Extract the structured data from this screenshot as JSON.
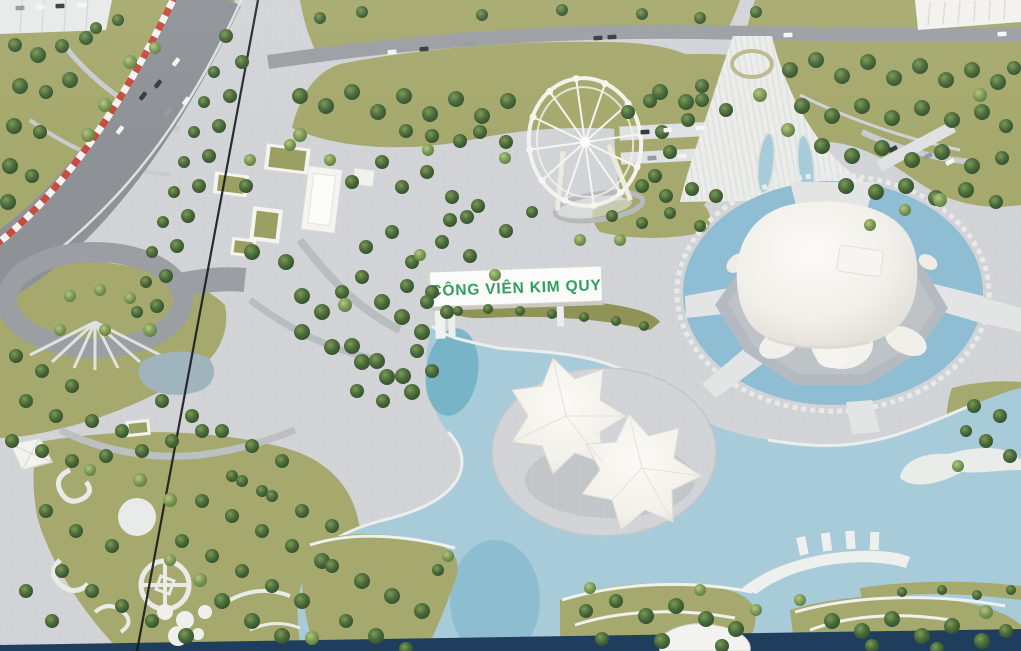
{
  "scene": {
    "kind": "photograph-of-architectural-scale-model",
    "subject": "aerial view of a park master-plan miniature with turtle-shaped building, leaf canopy building, ferris wheel, lake, roads and trees",
    "sign": {
      "text": "CÔNG VIÊN KIM QUY"
    }
  },
  "colors": {
    "plaza": "#d2d4d7",
    "plazaLine": "#bfc3c7",
    "lawn": "#a6a96d",
    "lawnDark": "#8f9355",
    "lawnLight": "#b5b77f",
    "road": "#9b9fa4",
    "roadDark": "#8e9297",
    "pathLight": "#c9ccd0",
    "white": "#f3f2ee",
    "whiteShadow": "#d7d6d0",
    "water": "#a7cbd9",
    "waterMoat": "#8fbdd3",
    "waterDeep": "#6fb0c4",
    "navy": "#1f3d5c",
    "barrierRed": "#c74b3f",
    "signGreen": "#2f9e5f",
    "seam": "#17181b"
  },
  "car_colors": {
    "w": "#f5f5f3",
    "d": "#363b42",
    "g": "#959ba3"
  },
  "trees": {
    "dark": [
      [
        15,
        45,
        7
      ],
      [
        38,
        55,
        8
      ],
      [
        62,
        46,
        7
      ],
      [
        86,
        38,
        7
      ],
      [
        20,
        86,
        8
      ],
      [
        46,
        92,
        7
      ],
      [
        70,
        80,
        8
      ],
      [
        14,
        126,
        8
      ],
      [
        40,
        132,
        7
      ],
      [
        10,
        166,
        8
      ],
      [
        32,
        176,
        7
      ],
      [
        8,
        202,
        8
      ],
      [
        96,
        28,
        6
      ],
      [
        118,
        20,
        6
      ],
      [
        226,
        36,
        7
      ],
      [
        242,
        62,
        7
      ],
      [
        214,
        72,
        6
      ],
      [
        230,
        96,
        7
      ],
      [
        204,
        102,
        6
      ],
      [
        219,
        126,
        7
      ],
      [
        194,
        132,
        6
      ],
      [
        209,
        156,
        7
      ],
      [
        184,
        162,
        6
      ],
      [
        199,
        186,
        7
      ],
      [
        174,
        192,
        6
      ],
      [
        188,
        216,
        7
      ],
      [
        163,
        222,
        6
      ],
      [
        177,
        246,
        7
      ],
      [
        152,
        252,
        6
      ],
      [
        166,
        276,
        7
      ],
      [
        146,
        282,
        6
      ],
      [
        157,
        306,
        7
      ],
      [
        137,
        312,
        6
      ],
      [
        246,
        186,
        7
      ],
      [
        252,
        252,
        8
      ],
      [
        286,
        262,
        8
      ],
      [
        302,
        296,
        8
      ],
      [
        322,
        312,
        8
      ],
      [
        342,
        292,
        7
      ],
      [
        362,
        277,
        7
      ],
      [
        382,
        302,
        8
      ],
      [
        402,
        317,
        8
      ],
      [
        422,
        332,
        8
      ],
      [
        366,
        247,
        7
      ],
      [
        392,
        232,
        7
      ],
      [
        412,
        262,
        7
      ],
      [
        432,
        292,
        7
      ],
      [
        447,
        312,
        7
      ],
      [
        352,
        182,
        7
      ],
      [
        382,
        162,
        7
      ],
      [
        402,
        187,
        7
      ],
      [
        427,
        172,
        7
      ],
      [
        452,
        197,
        7
      ],
      [
        467,
        217,
        7
      ],
      [
        442,
        242,
        7
      ],
      [
        302,
        332,
        8
      ],
      [
        332,
        347,
        8
      ],
      [
        362,
        362,
        8
      ],
      [
        387,
        377,
        8
      ],
      [
        412,
        392,
        8
      ],
      [
        352,
        346,
        8
      ],
      [
        377,
        361,
        8
      ],
      [
        403,
        376,
        8
      ],
      [
        417,
        351,
        7
      ],
      [
        427,
        302,
        7
      ],
      [
        407,
        286,
        7
      ],
      [
        432,
        371,
        7
      ],
      [
        357,
        391,
        7
      ],
      [
        383,
        401,
        7
      ],
      [
        300,
        96,
        8
      ],
      [
        326,
        106,
        8
      ],
      [
        352,
        92,
        8
      ],
      [
        378,
        112,
        8
      ],
      [
        404,
        96,
        8
      ],
      [
        430,
        114,
        8
      ],
      [
        456,
        99,
        8
      ],
      [
        482,
        116,
        8
      ],
      [
        508,
        101,
        8
      ],
      [
        480,
        132,
        7
      ],
      [
        506,
        142,
        7
      ],
      [
        460,
        141,
        7
      ],
      [
        432,
        136,
        7
      ],
      [
        406,
        131,
        7
      ],
      [
        660,
        92,
        8
      ],
      [
        686,
        102,
        8
      ],
      [
        702,
        86,
        7
      ],
      [
        662,
        132,
        7
      ],
      [
        688,
        120,
        7
      ],
      [
        670,
        152,
        7
      ],
      [
        655,
        176,
        7
      ],
      [
        320,
        18,
        6
      ],
      [
        362,
        12,
        6
      ],
      [
        482,
        15,
        6
      ],
      [
        562,
        10,
        6
      ],
      [
        642,
        14,
        6
      ],
      [
        700,
        18,
        6
      ],
      [
        756,
        12,
        6
      ],
      [
        790,
        70,
        8
      ],
      [
        816,
        60,
        8
      ],
      [
        842,
        76,
        8
      ],
      [
        868,
        62,
        8
      ],
      [
        894,
        78,
        8
      ],
      [
        920,
        66,
        8
      ],
      [
        946,
        80,
        8
      ],
      [
        972,
        70,
        8
      ],
      [
        998,
        82,
        8
      ],
      [
        1014,
        68,
        7
      ],
      [
        802,
        106,
        8
      ],
      [
        832,
        116,
        8
      ],
      [
        862,
        106,
        8
      ],
      [
        892,
        118,
        8
      ],
      [
        922,
        108,
        8
      ],
      [
        952,
        120,
        8
      ],
      [
        982,
        112,
        8
      ],
      [
        1006,
        126,
        7
      ],
      [
        822,
        146,
        8
      ],
      [
        852,
        156,
        8
      ],
      [
        882,
        148,
        8
      ],
      [
        912,
        160,
        8
      ],
      [
        942,
        152,
        8
      ],
      [
        972,
        166,
        8
      ],
      [
        1002,
        158,
        7
      ],
      [
        846,
        186,
        8
      ],
      [
        876,
        192,
        8
      ],
      [
        906,
        186,
        8
      ],
      [
        936,
        198,
        8
      ],
      [
        966,
        190,
        8
      ],
      [
        996,
        202,
        7
      ],
      [
        628,
        112,
        7
      ],
      [
        650,
        101,
        7
      ],
      [
        702,
        100,
        7
      ],
      [
        726,
        110,
        7
      ],
      [
        642,
        186,
        7
      ],
      [
        666,
        196,
        7
      ],
      [
        692,
        189,
        7
      ],
      [
        716,
        196,
        7
      ],
      [
        612,
        216,
        6
      ],
      [
        642,
        223,
        6
      ],
      [
        670,
        213,
        6
      ],
      [
        700,
        226,
        6
      ],
      [
        450,
        220,
        7
      ],
      [
        478,
        206,
        7
      ],
      [
        506,
        231,
        7
      ],
      [
        470,
        256,
        7
      ],
      [
        532,
        212,
        6
      ],
      [
        458,
        311,
        5
      ],
      [
        488,
        309,
        5
      ],
      [
        520,
        311,
        5
      ],
      [
        552,
        314,
        5
      ],
      [
        584,
        317,
        5
      ],
      [
        616,
        321,
        5
      ],
      [
        644,
        326,
        5
      ],
      [
        974,
        406,
        7
      ],
      [
        1000,
        416,
        7
      ],
      [
        986,
        441,
        7
      ],
      [
        1010,
        456,
        7
      ],
      [
        966,
        431,
        6
      ],
      [
        16,
        356,
        7
      ],
      [
        42,
        371,
        7
      ],
      [
        72,
        386,
        7
      ],
      [
        26,
        401,
        7
      ],
      [
        56,
        416,
        7
      ],
      [
        92,
        421,
        7
      ],
      [
        122,
        431,
        7
      ],
      [
        12,
        441,
        7
      ],
      [
        42,
        451,
        7
      ],
      [
        72,
        461,
        7
      ],
      [
        106,
        456,
        7
      ],
      [
        142,
        451,
        7
      ],
      [
        172,
        441,
        7
      ],
      [
        202,
        431,
        7
      ],
      [
        162,
        401,
        7
      ],
      [
        192,
        416,
        7
      ],
      [
        222,
        431,
        7
      ],
      [
        252,
        446,
        7
      ],
      [
        282,
        461,
        7
      ],
      [
        232,
        476,
        6
      ],
      [
        262,
        491,
        6
      ],
      [
        46,
        511,
        7
      ],
      [
        76,
        531,
        7
      ],
      [
        112,
        546,
        7
      ],
      [
        62,
        571,
        7
      ],
      [
        92,
        591,
        7
      ],
      [
        122,
        606,
        7
      ],
      [
        152,
        621,
        7
      ],
      [
        186,
        636,
        8
      ],
      [
        52,
        621,
        7
      ],
      [
        26,
        591,
        7
      ],
      [
        222,
        601,
        8
      ],
      [
        252,
        621,
        8
      ],
      [
        282,
        636,
        8
      ],
      [
        182,
        541,
        7
      ],
      [
        212,
        556,
        7
      ],
      [
        242,
        571,
        7
      ],
      [
        272,
        586,
        7
      ],
      [
        302,
        601,
        8
      ],
      [
        202,
        501,
        7
      ],
      [
        232,
        516,
        7
      ],
      [
        262,
        531,
        7
      ],
      [
        292,
        546,
        7
      ],
      [
        322,
        561,
        8
      ],
      [
        242,
        481,
        6
      ],
      [
        272,
        496,
        6
      ],
      [
        302,
        511,
        7
      ],
      [
        332,
        526,
        7
      ],
      [
        332,
        566,
        7
      ],
      [
        362,
        581,
        8
      ],
      [
        392,
        596,
        8
      ],
      [
        422,
        611,
        8
      ],
      [
        346,
        621,
        7
      ],
      [
        376,
        636,
        8
      ],
      [
        406,
        649,
        7
      ],
      [
        438,
        570,
        6
      ],
      [
        586,
        611,
        7
      ],
      [
        616,
        601,
        7
      ],
      [
        646,
        616,
        8
      ],
      [
        676,
        606,
        8
      ],
      [
        706,
        619,
        8
      ],
      [
        736,
        629,
        8
      ],
      [
        602,
        639,
        7
      ],
      [
        662,
        641,
        8
      ],
      [
        722,
        646,
        7
      ],
      [
        832,
        621,
        8
      ],
      [
        862,
        631,
        8
      ],
      [
        892,
        619,
        8
      ],
      [
        922,
        636,
        8
      ],
      [
        952,
        626,
        8
      ],
      [
        982,
        641,
        8
      ],
      [
        1006,
        631,
        7
      ],
      [
        872,
        646,
        7
      ],
      [
        937,
        649,
        7
      ],
      [
        902,
        592,
        5
      ],
      [
        942,
        590,
        5
      ],
      [
        977,
        595,
        5
      ],
      [
        1011,
        590,
        5
      ]
    ],
    "light": [
      [
        130,
        62,
        7
      ],
      [
        155,
        48,
        6
      ],
      [
        105,
        105,
        7
      ],
      [
        88,
        135,
        7
      ],
      [
        300,
        135,
        7
      ],
      [
        428,
        150,
        6
      ],
      [
        505,
        158,
        6
      ],
      [
        330,
        160,
        6
      ],
      [
        250,
        160,
        6
      ],
      [
        290,
        145,
        6
      ],
      [
        760,
        95,
        7
      ],
      [
        788,
        130,
        7
      ],
      [
        980,
        95,
        7
      ],
      [
        940,
        200,
        7
      ],
      [
        620,
        240,
        6
      ],
      [
        580,
        240,
        6
      ],
      [
        150,
        330,
        7
      ],
      [
        60,
        330,
        6
      ],
      [
        105,
        330,
        6
      ],
      [
        70,
        296,
        6
      ],
      [
        100,
        290,
        6
      ],
      [
        130,
        298,
        6
      ],
      [
        140,
        480,
        7
      ],
      [
        170,
        500,
        7
      ],
      [
        90,
        470,
        6
      ],
      [
        200,
        580,
        7
      ],
      [
        170,
        560,
        6
      ],
      [
        312,
        638,
        7
      ],
      [
        448,
        556,
        6
      ],
      [
        590,
        588,
        6
      ],
      [
        700,
        590,
        6
      ],
      [
        756,
        610,
        6
      ],
      [
        800,
        600,
        6
      ],
      [
        986,
        612,
        7
      ],
      [
        958,
        466,
        6
      ],
      [
        345,
        305,
        7
      ],
      [
        420,
        255,
        6
      ],
      [
        495,
        275,
        6
      ],
      [
        905,
        210,
        6
      ],
      [
        870,
        225,
        6
      ]
    ]
  },
  "cars": [
    [
      176,
      62,
      -52,
      "w"
    ],
    [
      158,
      84,
      -52,
      "d"
    ],
    [
      186,
      101,
      -52,
      "w"
    ],
    [
      168,
      112,
      -52,
      "g"
    ],
    [
      143,
      96,
      -52,
      "d"
    ],
    [
      120,
      130,
      -52,
      "w"
    ],
    [
      392,
      52,
      -4,
      "w"
    ],
    [
      424,
      49,
      -4,
      "d"
    ],
    [
      470,
      44,
      -4,
      "g"
    ],
    [
      598,
      38,
      -3,
      "d"
    ],
    [
      612,
      37,
      -3,
      "d"
    ],
    [
      788,
      35,
      -2,
      "w"
    ],
    [
      1002,
      34,
      -2,
      "w"
    ],
    [
      20,
      8,
      -2,
      "g"
    ],
    [
      40,
      7,
      -2,
      "w"
    ],
    [
      60,
      6,
      -2,
      "d"
    ],
    [
      82,
      5,
      -2,
      "w"
    ],
    [
      645,
      132,
      -4,
      "d"
    ],
    [
      668,
      130,
      -4,
      "w"
    ],
    [
      700,
      128,
      -4,
      "w"
    ],
    [
      652,
      158,
      -4,
      "g"
    ],
    [
      682,
      156,
      -4,
      "w"
    ],
    [
      893,
      149,
      -28,
      "d"
    ],
    [
      928,
      156,
      -28,
      "g"
    ],
    [
      950,
      162,
      -28,
      "w"
    ]
  ]
}
